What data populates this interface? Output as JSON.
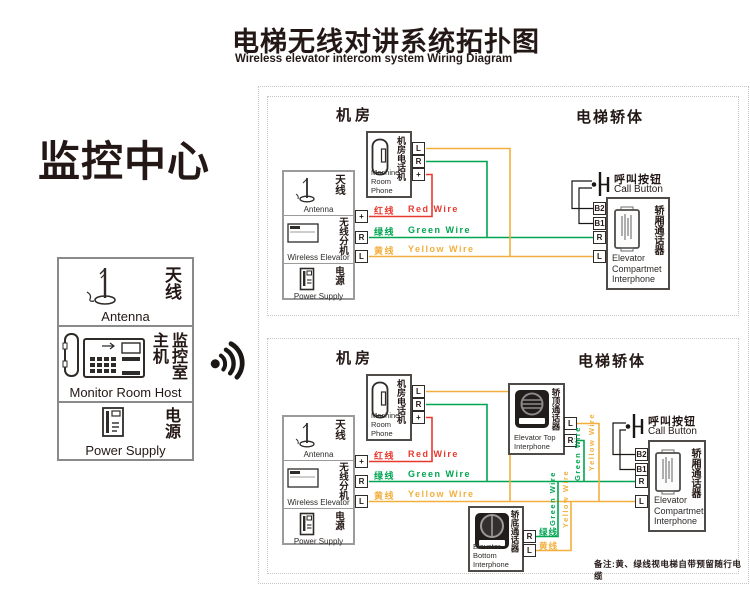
{
  "header": {
    "title_cn": "电梯无线对讲系统拓扑图",
    "title_en": "Wireless elevator intercom system Wiring Diagram"
  },
  "monitor_center": {
    "title": "监控中心",
    "antenna_cn": "天线",
    "antenna_en": "Antenna",
    "host_cn": "监控室主机",
    "host_en": "Monitor Room Host",
    "power_cn": "电源",
    "power_en": "Power Supply"
  },
  "section_labels": {
    "machine_room": "机房",
    "elevator_car": "电梯轿体"
  },
  "devices": {
    "antenna_cn": "天线",
    "antenna_en": "Antenna",
    "wireless_cn": "无线分机",
    "wireless_en": "Wireless Elevator",
    "power_cn": "电源",
    "power_en": "Power Supply",
    "machine_phone_cn": "机房电话机",
    "machine_phone_en_l1": "Machine",
    "machine_phone_en_l2": "Room Phone",
    "call_button_cn": "呼叫按钮",
    "call_button_en": "Call Button",
    "compartment_cn": "轿厢通话器",
    "compartment_en_l1": "Elevator",
    "compartment_en_l2": "Compartmet",
    "compartment_en_l3": "Interphone",
    "top_interphone_cn": "轿顶通话器",
    "top_interphone_en_l1": "Elevator Top",
    "top_interphone_en_l2": "Interphone",
    "bottom_interphone_cn": "轿底通话器",
    "bottom_interphone_en_l1": "Elevator Bottom",
    "bottom_interphone_en_l2": "Interphone"
  },
  "terminals": {
    "plus": "+",
    "r": "R",
    "l": "L",
    "b1": "B1",
    "b2": "B2"
  },
  "wires": {
    "red_cn": "红线",
    "red_en": "Red Wire",
    "green_cn": "绿线",
    "green_en": "Green Wire",
    "yellow_cn": "黄线",
    "yellow_en": "Yellow Wire",
    "green_vert": "Green Wire",
    "yellow_vert": "Yellow Wire",
    "colors": {
      "red": "#e8392e",
      "green": "#00a551",
      "yellow": "#f3af3d",
      "ink": "#231815"
    }
  },
  "note": "备注:黄、绿线视电梯自带预留随行电缆"
}
